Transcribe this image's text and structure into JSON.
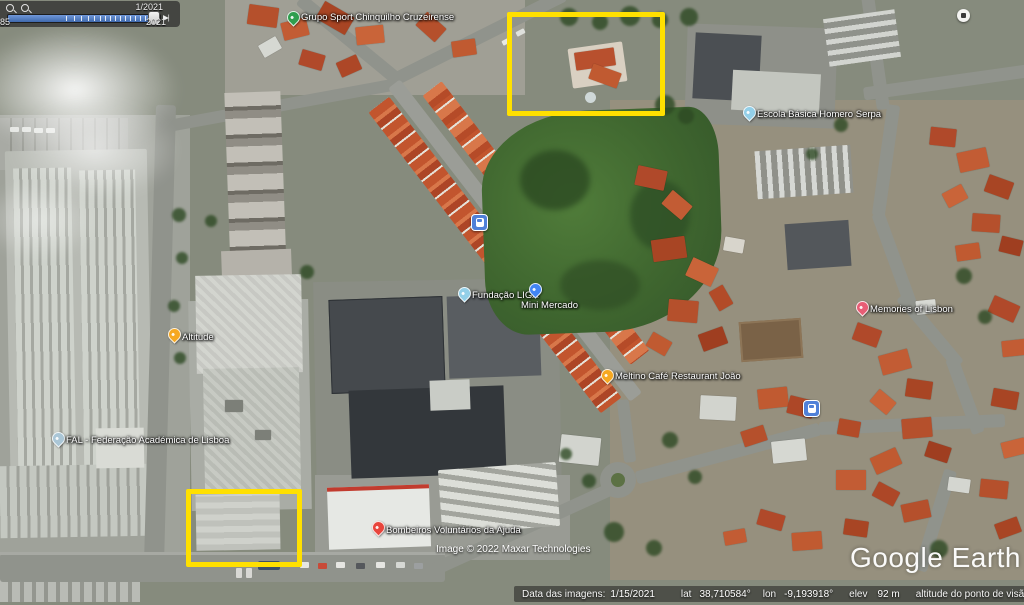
{
  "app": {
    "watermark": "Google Earth",
    "imagery_credit": "Image © 2022 Maxar Technologies"
  },
  "timeline": {
    "current_date": "1/2021",
    "start_label": "1985",
    "end_label": "2021",
    "step_forward_icon": "▶|"
  },
  "status_bar": {
    "imagery_date_label": "Data das imagens:",
    "imagery_date": "1/15/2021",
    "lat_label": "lat",
    "lat": "38,710584°",
    "lon_label": "lon",
    "lon": "-9,193918°",
    "elev_label": "elev",
    "elev": "92 m",
    "eye_alt_label": "altitude do ponto de visão",
    "eye_alt": "536 m"
  },
  "pois": [
    {
      "label": "Grupo Sport Chinquilho Cruzeirense",
      "pin_color": "#2f9e4e"
    },
    {
      "label": "Escola Básica Homero Serpa",
      "pin_color": "#93cfe8"
    },
    {
      "label": "Fundação LIGA",
      "pin_color": "#93cfe8"
    },
    {
      "label": "Mini Mercado",
      "pin_color": "#4285f4"
    },
    {
      "label": "Altitude",
      "pin_color": "#f6a821"
    },
    {
      "label": "Meltino Café Restaurant João",
      "pin_color": "#f6a821"
    },
    {
      "label": "FAL - Federação Académica de Lisboa",
      "pin_color": "#aac6d6"
    },
    {
      "label": "Memories of Lisbon",
      "pin_color": "#e85d75"
    },
    {
      "label": "Bombeiros Voluntários da Ajuda",
      "pin_color": "#e8453c"
    }
  ],
  "icons": {
    "bus_stop": "bus-in-blue-rounded-square",
    "photo": "white-circle-photo",
    "compass": "blue-white-orbit-circle",
    "time_zoom": "magnifier"
  },
  "annotations": {
    "highlight_color": "#ffe000",
    "boxes": [
      {
        "x": 507,
        "y": 12,
        "w": 148,
        "h": 94
      },
      {
        "x": 186,
        "y": 489,
        "w": 106,
        "h": 68
      }
    ]
  }
}
